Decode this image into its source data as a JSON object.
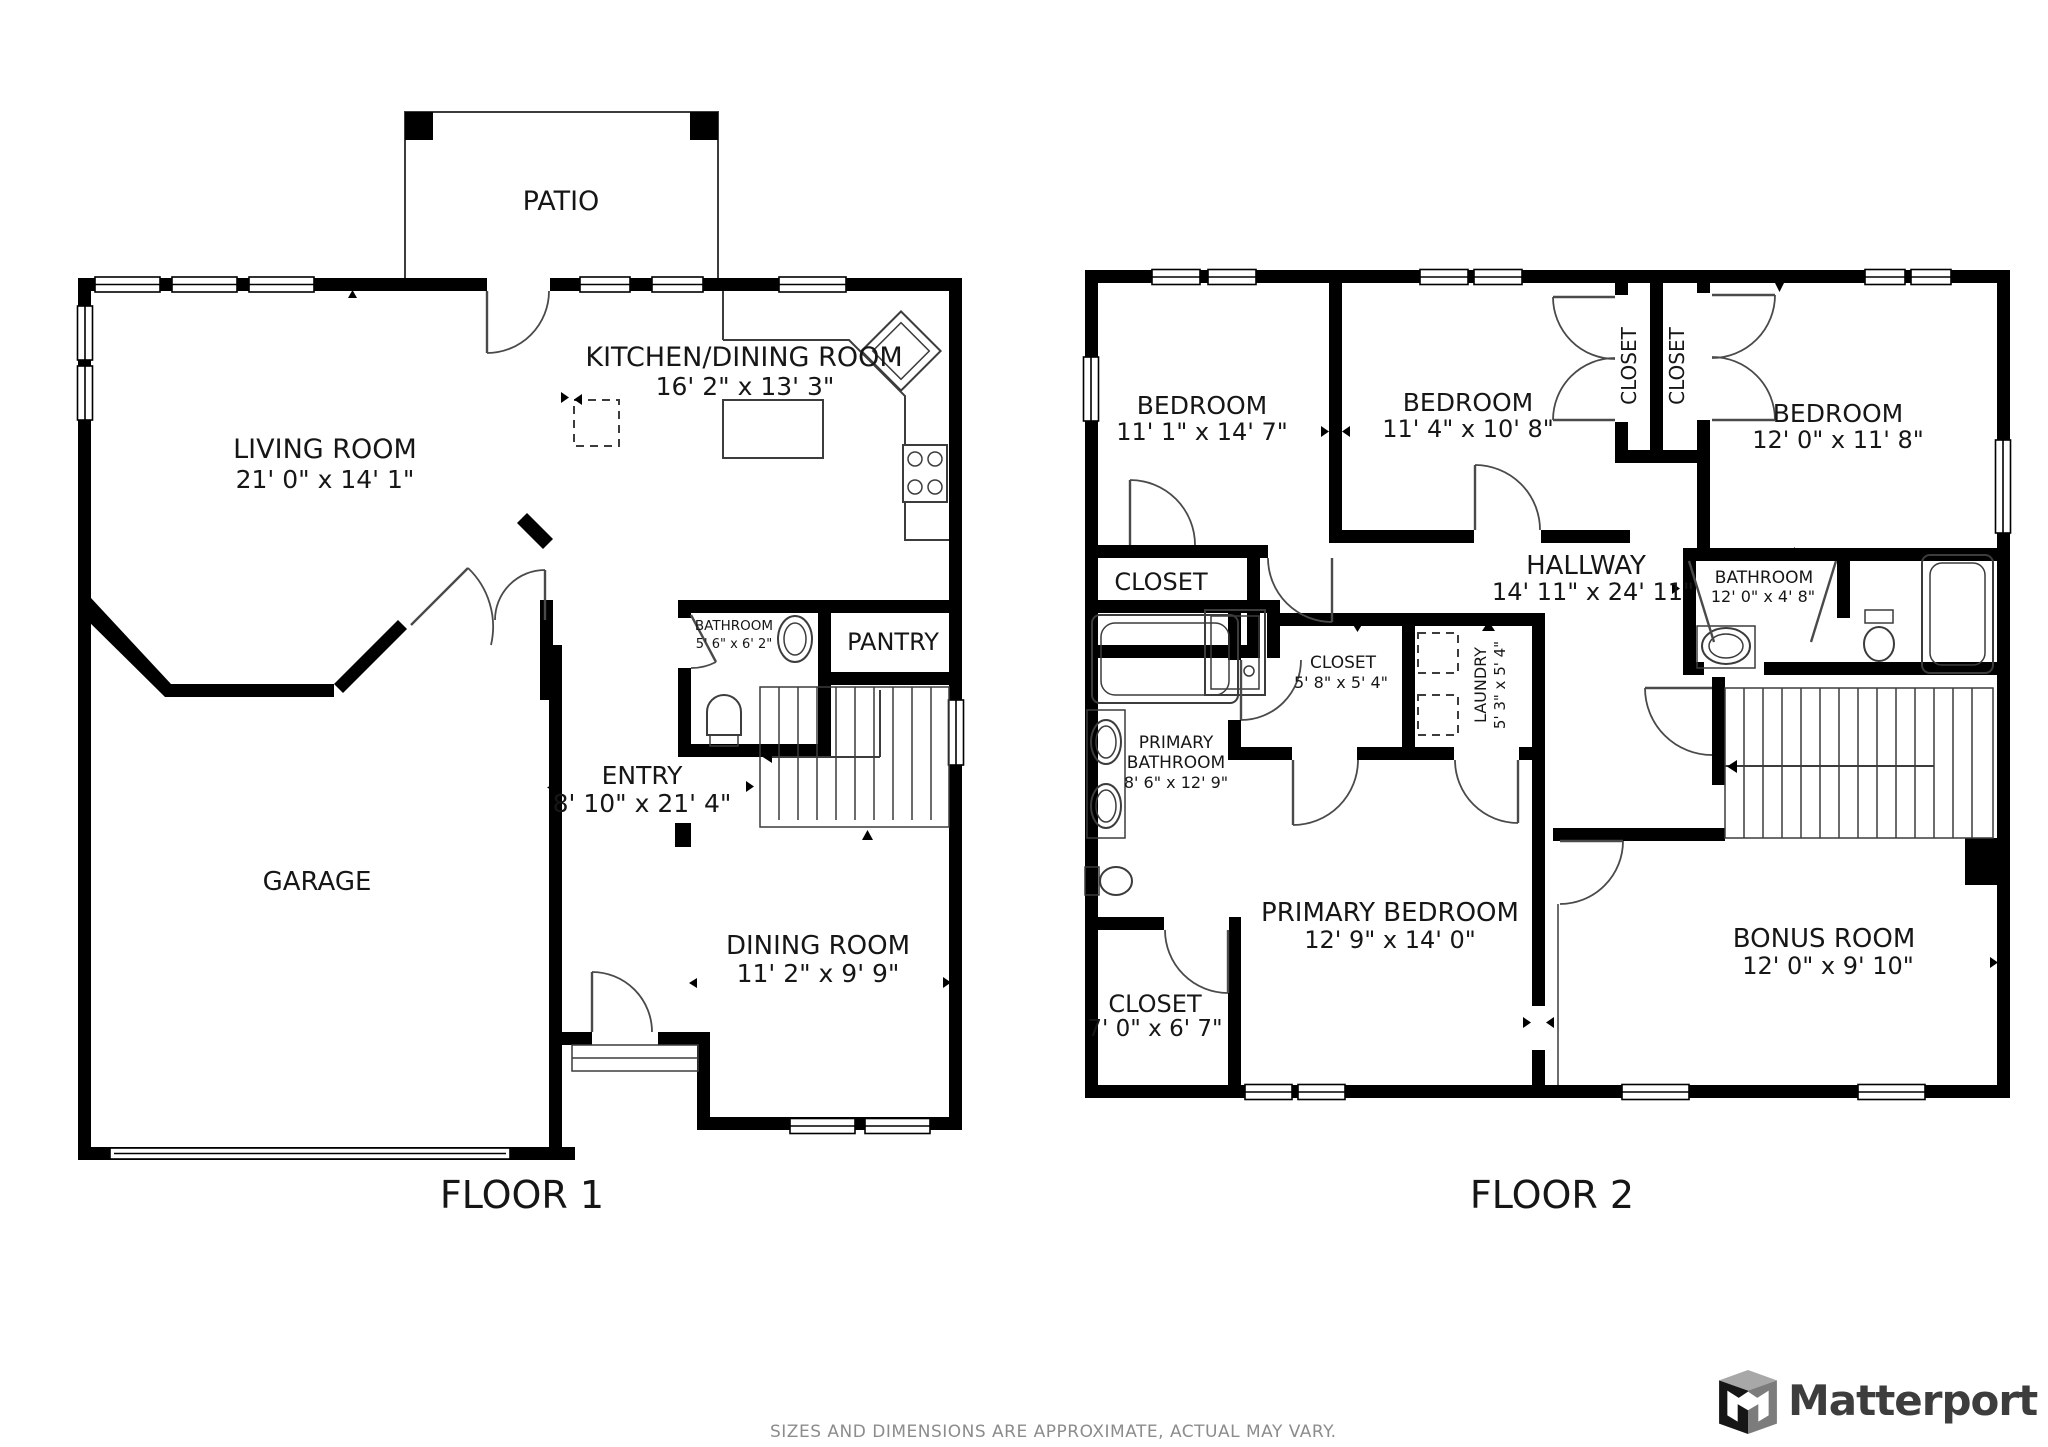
{
  "colors": {
    "wall": "#000000",
    "fixture_line": "#3c3c3c",
    "label_text": "#161616",
    "disclaimer_gray": "#8c8c8c",
    "brand_gray": "#3d3d3d",
    "background": "#ffffff"
  },
  "footer": {
    "disclaimer": "SIZES AND DIMENSIONS ARE APPROXIMATE, ACTUAL MAY VARY.",
    "brand": "Matterport"
  },
  "floor1": {
    "label": "FLOOR 1",
    "rooms": {
      "patio": {
        "name": "PATIO"
      },
      "living_room": {
        "name": "LIVING ROOM",
        "dims": "21' 0\" x 14' 1\""
      },
      "kitchen_dining_room": {
        "name": "KITCHEN/DINING ROOM",
        "dims": "16' 2\" x 13' 3\""
      },
      "bathroom": {
        "name": "BATHROOM",
        "dims": "5' 6\" x 6' 2\""
      },
      "pantry": {
        "name": "PANTRY"
      },
      "entry": {
        "name": "ENTRY",
        "dims": "8' 10\" x 21' 4\""
      },
      "garage": {
        "name": "GARAGE"
      },
      "dining_room": {
        "name": "DINING ROOM",
        "dims": "11' 2\" x 9' 9\""
      }
    }
  },
  "floor2": {
    "label": "FLOOR 2",
    "rooms": {
      "bedroom_1": {
        "name": "BEDROOM",
        "dims": "11' 1\" x 14' 7\""
      },
      "bedroom_2": {
        "name": "BEDROOM",
        "dims": "11' 4\" x 10' 8\""
      },
      "bedroom_3": {
        "name": "BEDROOM",
        "dims": "12' 0\" x 11' 8\""
      },
      "closet_a": {
        "name": "CLOSET"
      },
      "closet_b": {
        "name": "CLOSET"
      },
      "closet_bed1": {
        "name": "CLOSET"
      },
      "hallway": {
        "name": "HALLWAY",
        "dims": "14' 11\" x 24' 11\""
      },
      "bathroom": {
        "name": "BATHROOM",
        "dims": "12' 0\" x 4' 8\""
      },
      "closet_hall": {
        "name": "CLOSET",
        "dims": "5' 8\" x 5' 4\""
      },
      "laundry": {
        "name": "LAUNDRY",
        "dims": "5' 3\" x 5' 4\""
      },
      "primary_bathroom": {
        "name_line1": "PRIMARY",
        "name_line2": "BATHROOM",
        "dims": "8' 6\" x 12' 9\""
      },
      "primary_bedroom": {
        "name": "PRIMARY BEDROOM",
        "dims": "12' 9\" x 14' 0\""
      },
      "closet_primary": {
        "name": "CLOSET",
        "dims": "7' 0\" x 6' 7\""
      },
      "bonus_room": {
        "name": "BONUS ROOM",
        "dims": "12' 0\" x 9' 10\""
      }
    }
  }
}
